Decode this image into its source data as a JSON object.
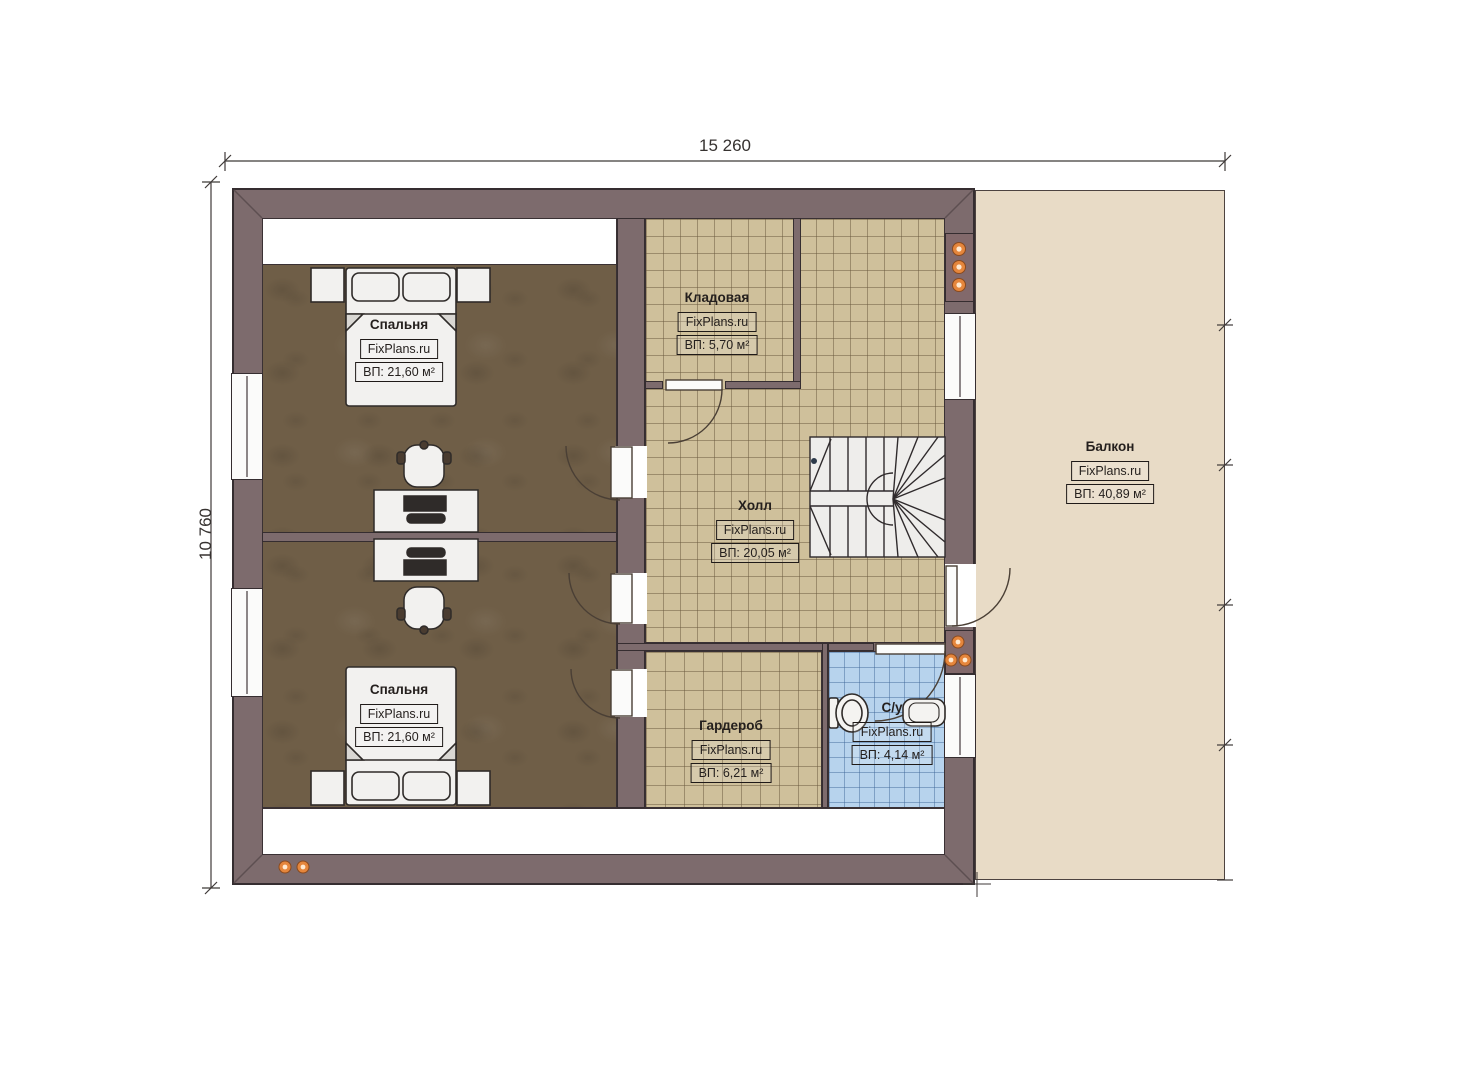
{
  "plan": {
    "title_dimensions": {
      "width": "15 260",
      "height": "10 760"
    },
    "rooms": [
      {
        "key": "bedroom-top",
        "name": "Спальня",
        "watermark": "FixPlans.ru",
        "area": "ВП: 21,60 м²"
      },
      {
        "key": "storage",
        "name": "Кладовая",
        "watermark": "FixPlans.ru",
        "area": "ВП: 5,70 м²"
      },
      {
        "key": "hall",
        "name": "Холл",
        "watermark": "FixPlans.ru",
        "area": "ВП: 20,05 м²"
      },
      {
        "key": "bedroom-bottom",
        "name": "Спальня",
        "watermark": "FixPlans.ru",
        "area": "ВП: 21,60 м²"
      },
      {
        "key": "wardrobe",
        "name": "Гардероб",
        "watermark": "FixPlans.ru",
        "area": "ВП: 6,21 м²"
      },
      {
        "key": "bathroom",
        "name": "С/у",
        "watermark": "FixPlans.ru",
        "area": "ВП: 4,14 м²"
      },
      {
        "key": "balcony",
        "name": "Балкон",
        "watermark": "FixPlans.ru",
        "area": "ВП: 40,89 м²"
      }
    ],
    "colors": {
      "wall": "#7d6b6d",
      "bedroom_floor": "#6f5e47",
      "tile_floor": "#cfc09b",
      "bath_floor": "#b7d3ed",
      "balcony": "#e8dbc6",
      "accent_dot": "#e5863c"
    }
  }
}
